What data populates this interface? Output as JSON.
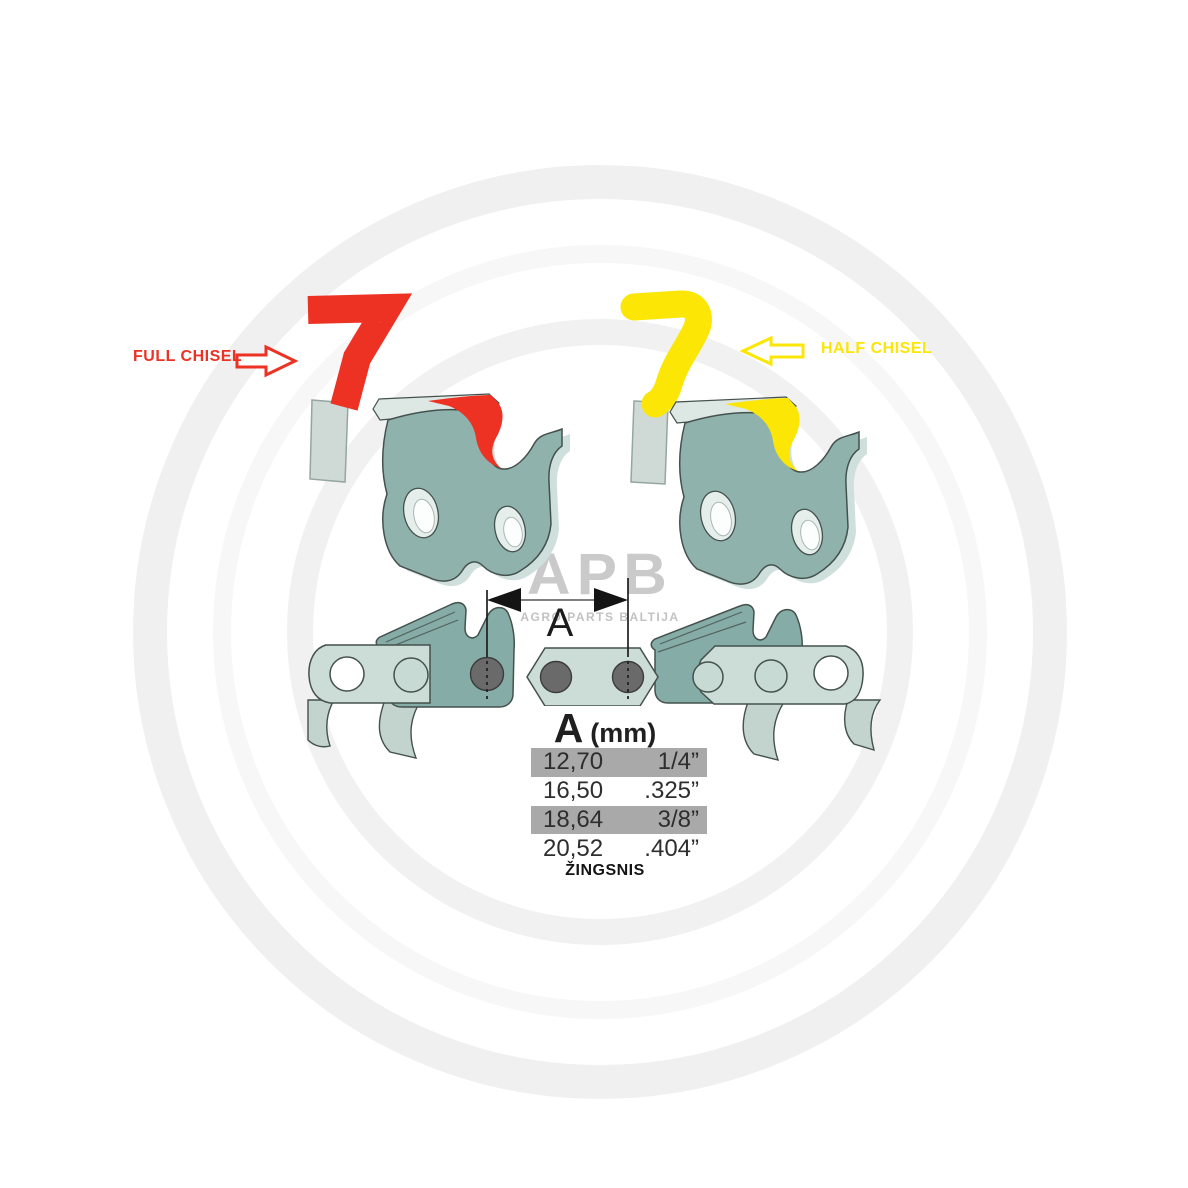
{
  "labels": {
    "full_chisel": "FULL CHISEL",
    "half_chisel": "HALF CHISEL"
  },
  "dimension": {
    "label": "A"
  },
  "watermark": {
    "logo": "APB",
    "subtitle": "AGRO PARTS BALTIJA"
  },
  "pitch_table": {
    "header_dimension": "A",
    "header_unit": "(mm)",
    "rows": [
      {
        "mm": "12,70",
        "inches": "1/4”",
        "highlighted": true
      },
      {
        "mm": "16,50",
        "inches": ".325”",
        "highlighted": false
      },
      {
        "mm": "18,64",
        "inches": "3/8”",
        "highlighted": true
      },
      {
        "mm": "20,52",
        "inches": ".404”",
        "highlighted": false
      }
    ],
    "footer": "ŽINGSNIS"
  },
  "icons": {
    "full_chisel_arrow": "right-arrow-outline-icon",
    "half_chisel_arrow": "left-arrow-outline-icon"
  },
  "colors": {
    "full_chisel_red": "#ED3123",
    "half_chisel_yellow": "#FBE606",
    "cutter_teal": "#8FB2AD",
    "cutter_dark_teal": "#85ACA6",
    "chain_light_teal": "#CCDCD7",
    "rivet_gray": "#6A6A6A",
    "highlight_gray": "#A9A9A9",
    "watermark_gray": "#CACACA"
  }
}
